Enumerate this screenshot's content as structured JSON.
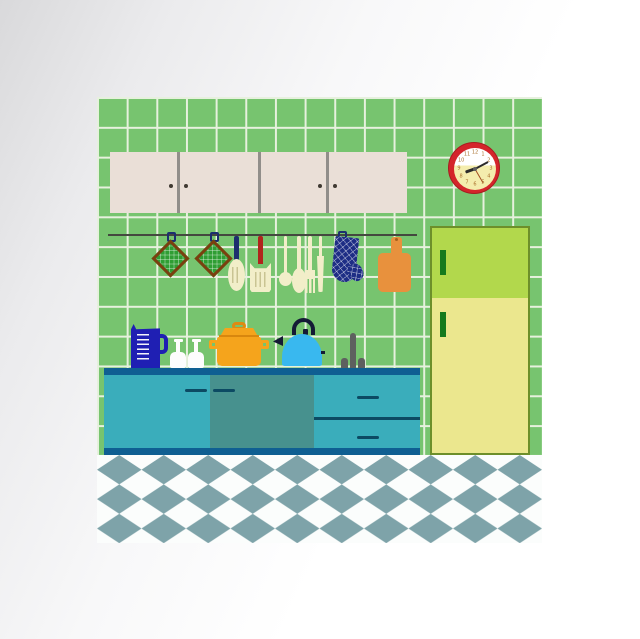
{
  "meta": {
    "description": "Flat vector illustration of a retro kitchen interior with green tiled wall, wall cabinets, hanging utensils, wall clock, teal counter with cookware, refrigerator and diamond-checkered floor",
    "canvas": "640x639"
  },
  "clock": {
    "numerals": [
      "12",
      "1",
      "2",
      "3",
      "4",
      "5",
      "6",
      "7",
      "8",
      "9",
      "10",
      "11"
    ],
    "hour_deg": 250,
    "minute_deg": 62,
    "second_deg": 150,
    "rim_color": "#d4252b",
    "face_top_color": "#ffffff",
    "face_bottom_color": "#f4edad",
    "numeral_color": "#a8702c"
  },
  "palette": {
    "wall_tile": "#77c46f",
    "tile_grout": "#e7f1de",
    "cabinet_beige": "#eadfd7",
    "cabinet_divider": "#918e8a",
    "rail": "#44483f",
    "potholder_green": "#2f9e33",
    "potholder_border": "#7a400f",
    "navy": "#1c2f6e",
    "red_handle": "#b0251c",
    "cream_utensil": "#f2eec9",
    "mitt_navy": "#1e2d85",
    "board_orange": "#e8913d",
    "fridge_top_green": "#b2d84c",
    "fridge_bottom_yellow": "#ebe78e",
    "fridge_handle_green": "#157a1d",
    "counter_trim_blue": "#0f5f92",
    "counter_teal_light": "#3aadbb",
    "counter_teal_dark": "#47918e",
    "counter_handle": "#0c4a63",
    "jug_blue": "#1f1fb3",
    "pot_orange": "#f5a41c",
    "kettle_blue": "#39b8ef",
    "kettle_dark": "#141a35",
    "faucet_gray": "#5e605f",
    "floor_diamond_gray": "#7ea3a9",
    "floor_white": "#fbfdfc"
  },
  "objects": {
    "wall": "green ceramic tile wall",
    "upper_cabinet": "four-door beige wall cabinet",
    "clock": "red wall clock",
    "rail_items": [
      "pot holder",
      "pot holder",
      "slotted spoon",
      "slotted turner",
      "ladle",
      "spoon",
      "fork",
      "knife",
      "oven mitt",
      "cutting board"
    ],
    "counter_items": [
      "measuring jug",
      "bottle",
      "bottle",
      "cooking pot",
      "kettle",
      "faucet"
    ],
    "counter": "teal kitchen counter with two doors and two drawers",
    "fridge": "two-door green refrigerator",
    "floor": "blue-gray and white diamond checkered floor"
  }
}
